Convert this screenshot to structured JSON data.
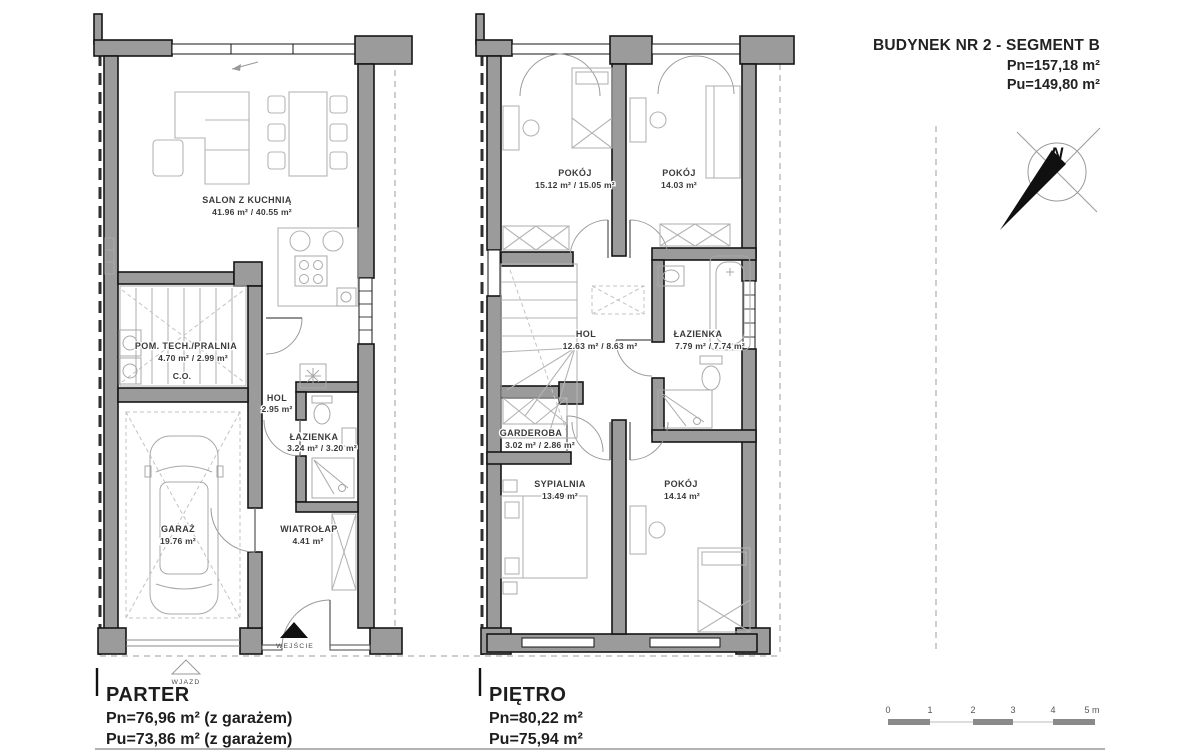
{
  "header": {
    "title": "BUDYNEK NR 2 - SEGMENT B",
    "pn": "Pn=157,18 m²",
    "pu": "Pu=149,80 m²"
  },
  "compass": {
    "north_label": "N"
  },
  "parter": {
    "name": "PARTER",
    "pn": "Pn=76,96 m² (z garażem)",
    "pu": "Pu=73,86 m² (z garażem)",
    "rooms": {
      "salon": {
        "name": "SALON Z KUCHNIĄ",
        "area": "41.96 m² / 40.55 m²"
      },
      "pralnia": {
        "name": "POM. TECH./PRALNIA",
        "area": "4.70 m² / 2.99 m²",
        "note": "C.O."
      },
      "hol": {
        "name": "HOL",
        "area": "2.95 m²"
      },
      "lazienka": {
        "name": "ŁAZIENKA",
        "area": "3.24 m² / 3.20 m²"
      },
      "garaz": {
        "name": "GARAŻ",
        "area": "19.76 m²"
      },
      "wiatrolap": {
        "name": "WIATROŁAP",
        "area": "4.41 m²"
      }
    },
    "entrance_label": "WEJŚCIE",
    "driveway_label": "WJAZD"
  },
  "pietro": {
    "name": "PIĘTRO",
    "pn": "Pn=80,22 m²",
    "pu": "Pu=75,94 m²",
    "rooms": {
      "pokoj1": {
        "name": "POKÓJ",
        "area": "15.12 m² / 15.05 m²"
      },
      "pokoj2": {
        "name": "POKÓJ",
        "area": "14.03 m²"
      },
      "hol": {
        "name": "HOL",
        "area": "12.63 m² / 8.63 m²"
      },
      "lazienka": {
        "name": "ŁAZIENKA",
        "area": "7.79 m² / 7.74 m²"
      },
      "garderoba": {
        "name": "GARDEROBA",
        "area": "3.02 m² / 2.86 m²"
      },
      "sypialnia": {
        "name": "SYPIALNIA",
        "area": "13.49 m²"
      },
      "pokoj3": {
        "name": "POKÓJ",
        "area": "14.14 m²"
      }
    }
  },
  "scale_bar": {
    "ticks": [
      "0",
      "1",
      "2",
      "3",
      "4",
      "5 m"
    ]
  },
  "colors": {
    "wall_fill": "#9b9b9b",
    "wall_stroke": "#161616",
    "furniture": "#b4b4b4",
    "boundary_dash": "#2f2f2f"
  }
}
